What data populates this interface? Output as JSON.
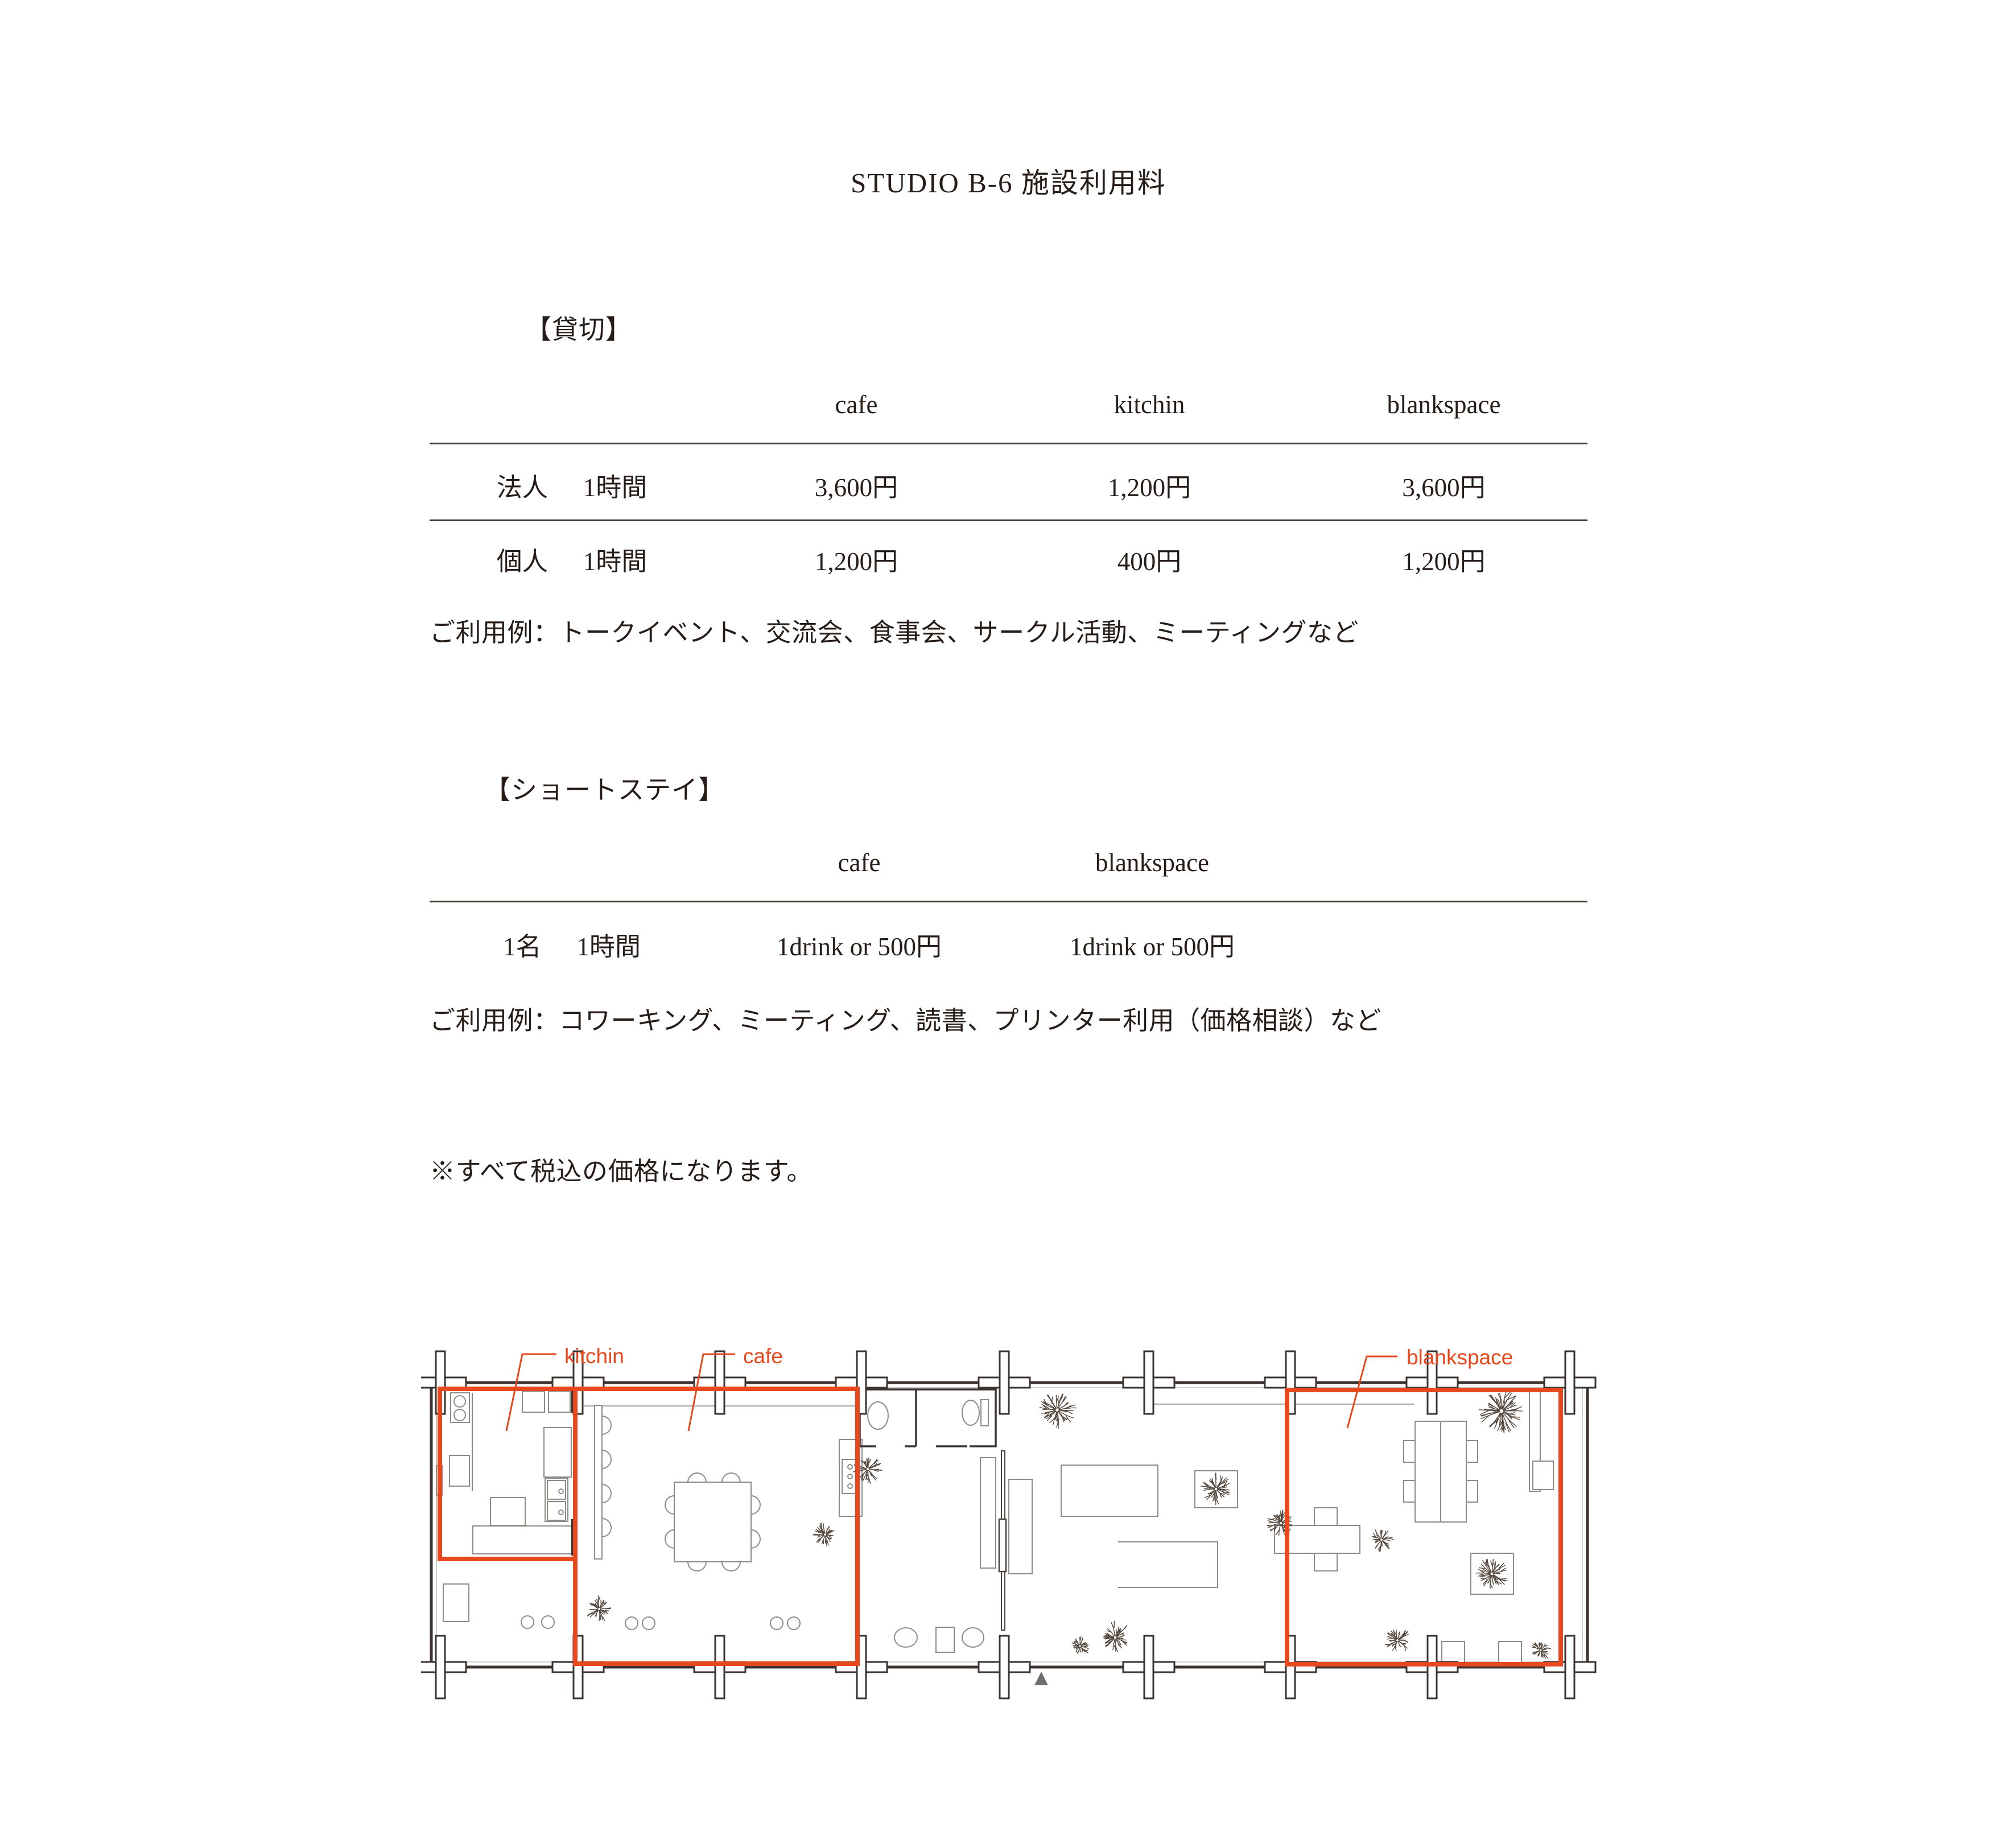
{
  "title": "STUDIO B-6 施設利用料",
  "sections": {
    "rental": {
      "heading": "【貸切】",
      "columns": [
        "cafe",
        "kitchin",
        "blankspace"
      ],
      "rows": [
        {
          "who": "法人",
          "duration": "1時間",
          "prices": [
            "3,600円",
            "1,200円",
            "3,600円"
          ]
        },
        {
          "who": "個人",
          "duration": "1時間",
          "prices": [
            "1,200円",
            "400円",
            "1,200円"
          ]
        }
      ],
      "usage_note": "ご利用例：トークイベント、交流会、食事会、サークル活動、ミーティングなど"
    },
    "short_stay": {
      "heading": "【ショートステイ】",
      "columns": [
        "cafe",
        "blankspace"
      ],
      "rows": [
        {
          "who": "1名",
          "duration": "1時間",
          "prices": [
            "1drink or 500円",
            "1drink or 500円"
          ]
        }
      ],
      "usage_note": "ご利用例：コワーキング、ミーティング、読書、プリンター利用（価格相談）など"
    }
  },
  "tax_note": "※すべて税込の価格になります。",
  "floor_plan": {
    "labels": [
      {
        "id": "kitchin",
        "text": "kitchin"
      },
      {
        "id": "cafe",
        "text": "cafe"
      },
      {
        "id": "blankspace",
        "text": "blankspace"
      }
    ],
    "accent_color": "#e8481e"
  },
  "colors": {
    "text": "#271d18",
    "accent": "#e8481e"
  }
}
